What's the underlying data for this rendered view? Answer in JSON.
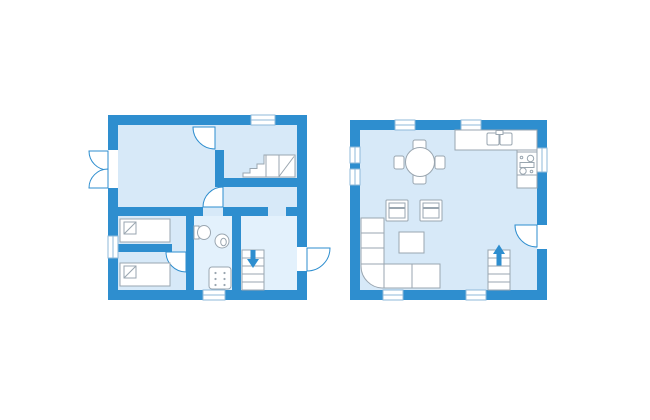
{
  "canvas": {
    "width": 650,
    "height": 420
  },
  "palette": {
    "bg": "#ffffff",
    "wall": "#2e8ecf",
    "floor": "#d7e9f8",
    "floor_light": "#e3f1fc",
    "fix_fill": "#ffffff",
    "fix_stroke": "#9aa6b0",
    "win": "#8fb9da"
  },
  "plans": [
    {
      "id": "ground-floor-plan",
      "icons": [
        "double-door",
        "interior-door-swing",
        "interior-door-swing",
        "interior-door-swing",
        "exterior-door-swing",
        "window",
        "window",
        "window",
        "single-bed",
        "single-bed",
        "toilet",
        "washbasin",
        "shower",
        "staircase",
        "staircase-down-arrow",
        "stair-landing"
      ]
    },
    {
      "id": "upper-floor-plan",
      "icons": [
        "window",
        "window",
        "window",
        "window",
        "window",
        "window",
        "window",
        "exterior-door-swing",
        "kitchen-counter",
        "double-sink",
        "stove-cooktop",
        "round-dining-table",
        "dining-chair",
        "dining-chair",
        "dining-chair",
        "dining-chair",
        "armchair",
        "armchair",
        "coffee-table",
        "corner-sofa",
        "staircase",
        "staircase-up-arrow"
      ]
    }
  ]
}
